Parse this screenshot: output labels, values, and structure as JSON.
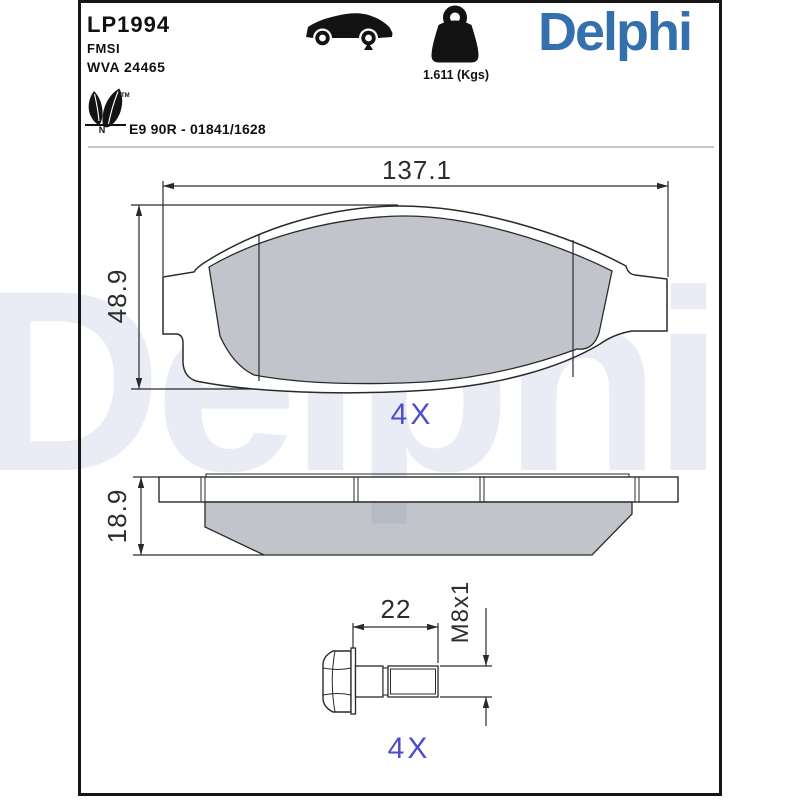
{
  "header": {
    "part_number": "LP1994",
    "fmsi_label": "FMSI",
    "wva_number": "WVA 24465",
    "weight_value": "1.611 (Kgs)",
    "brand_logo": "Delphi",
    "eco_trademark": "TM",
    "eco_letter": "N",
    "approval_number": "E9 90R - 01841/1628",
    "icons": {
      "vehicle": "car-side-silhouette-icon",
      "axle_marker": "triangle-marker-under-rear-wheel",
      "weight": "kettlebell-weight-icon",
      "eco": "double-leaf-icon"
    }
  },
  "watermark": {
    "text": "Delphi",
    "color": "#e9ecf4"
  },
  "drawings": {
    "pad_front_view": {
      "width_dim": "137.1",
      "height_dim": "48.9",
      "quantity_label": "4X"
    },
    "pad_top_view": {
      "thickness_dim": "18.9"
    },
    "bolt_view": {
      "length_dim": "22",
      "thread_spec": "M8x1",
      "quantity_label": "4X"
    }
  },
  "colors": {
    "logo_blue": "#3370AD",
    "quantity_blue": "#4D4DCA",
    "drawing_line": "#2a2a2a",
    "friction_gray": "#c6cad1",
    "watermark_gray": "#e9ecf4"
  }
}
